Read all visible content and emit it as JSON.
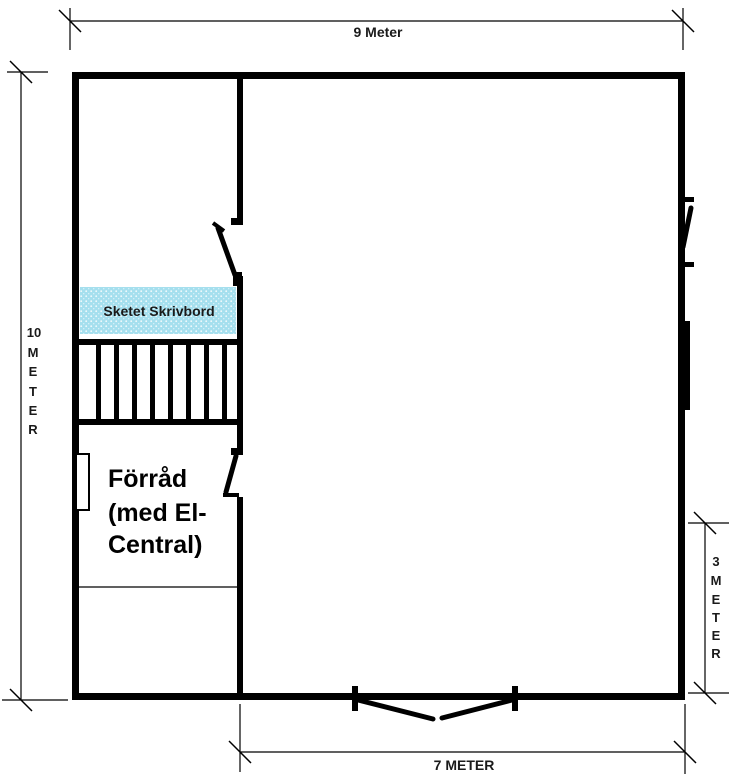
{
  "page": {
    "background": "#ffffff"
  },
  "dimensions": {
    "top": {
      "label": "9 Meter"
    },
    "bottom": {
      "label": "7 METER"
    },
    "left": {
      "label": "10 METER",
      "stack": [
        "10",
        "M",
        "E",
        "T",
        "E",
        "R"
      ]
    },
    "right": {
      "label": "3 METER",
      "stack": [
        "3",
        "M",
        "E",
        "T",
        "E",
        "R"
      ]
    }
  },
  "rooms": {
    "desk": {
      "label": "Sketet Skrivbord",
      "fill": "#a5dfee"
    },
    "storage": {
      "lines": [
        "Förråd",
        "(med El-",
        "Central)"
      ]
    }
  },
  "colors": {
    "wall": "#000000",
    "text": "#1a1a1a",
    "desk_fill": "#a5dfee"
  }
}
